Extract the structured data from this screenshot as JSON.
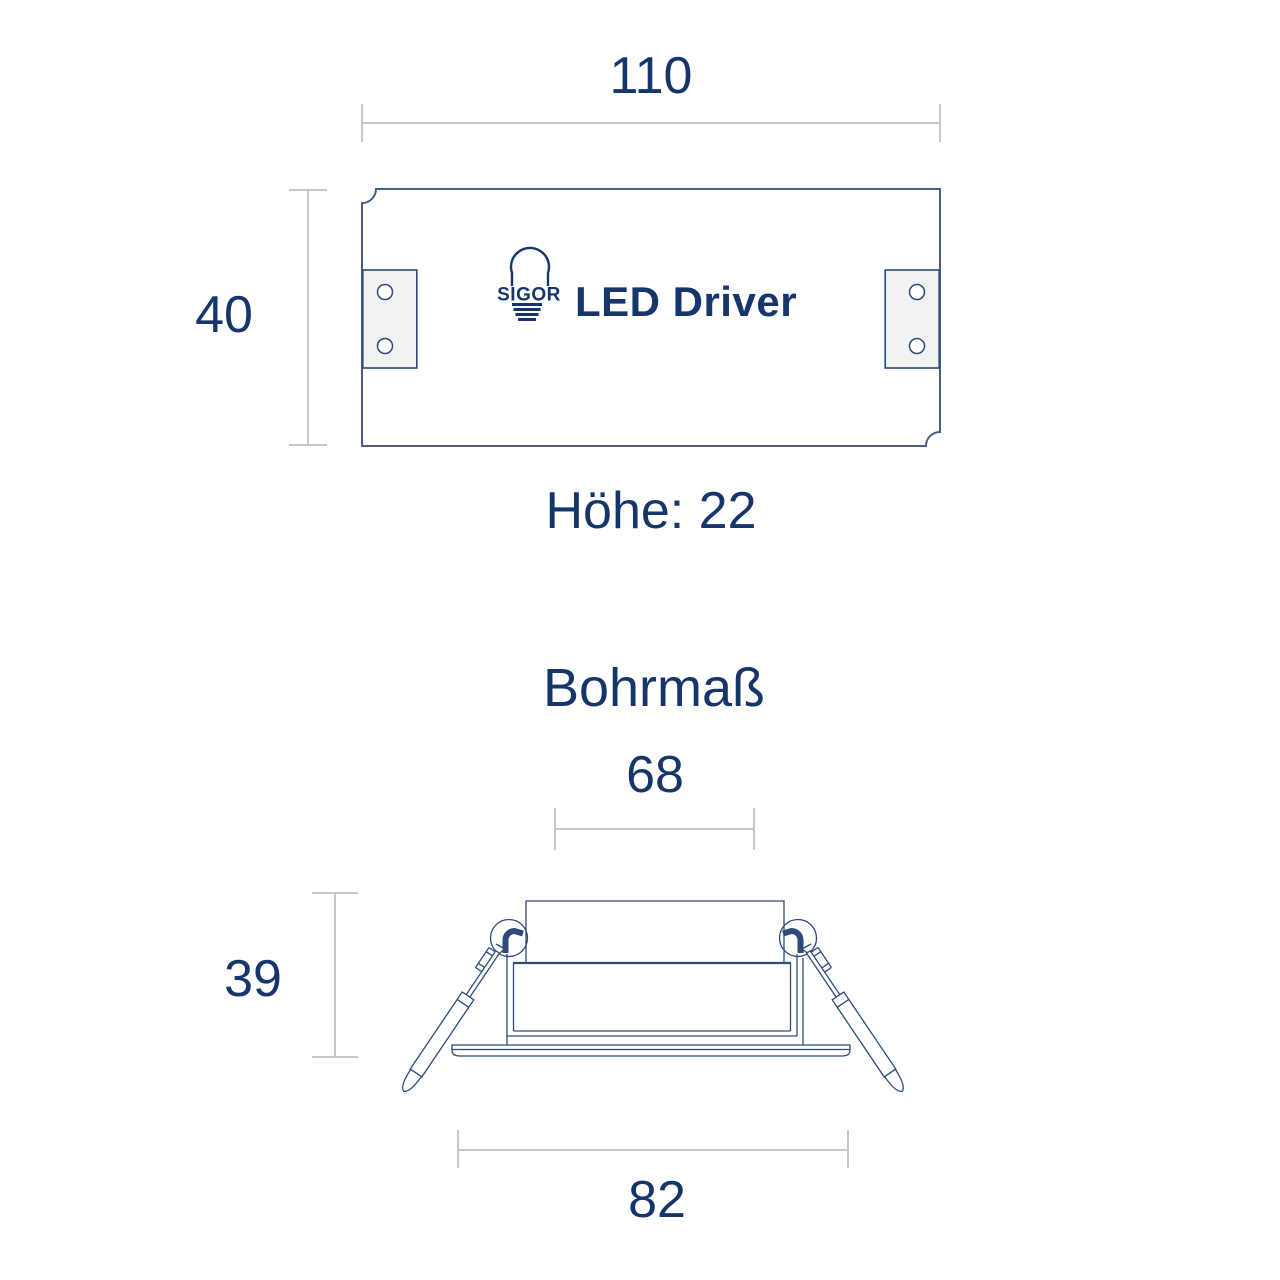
{
  "colors": {
    "text_navy": "#16356b",
    "line_navy": "#2e4a7a",
    "box_navy": "#4a5e84",
    "dim_gray": "#c8c8c8",
    "tab_fill": "#f2f2f2",
    "background": "#ffffff"
  },
  "driver_view": {
    "width_dim": "110",
    "height_dim": "40",
    "depth_label": "Höhe: 22",
    "logo_text": "SIGOR",
    "product_label": "LED Driver"
  },
  "cutout_view": {
    "title": "Bohrmaß",
    "bore_dim": "68",
    "depth_dim": "39",
    "flange_dim": "82"
  }
}
